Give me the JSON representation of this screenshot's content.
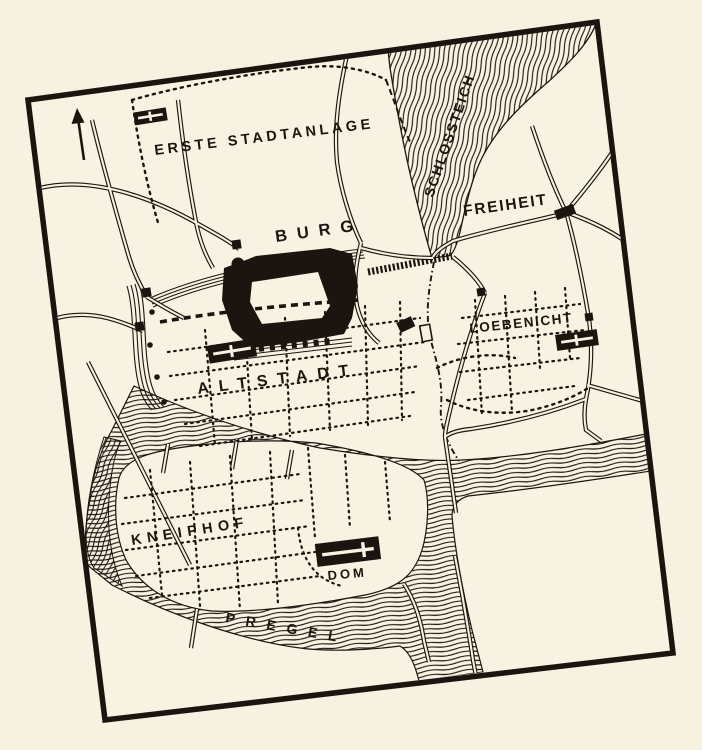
{
  "map": {
    "region_labels": {
      "erste_stadtanlage": "ERSTE STADTANLAGE",
      "schlossteich": "SCHLOSSTEICH",
      "freiheit": "FREIHEIT",
      "burg": "BURG",
      "altstadt": "ALTSTADT",
      "loebenicht": "LOEBENICHT",
      "kneiphof": "KNEIPHOF",
      "dom": "DOM",
      "pregel": "PREGEL"
    },
    "colors": {
      "paper": "#f6f1e1",
      "ink": "#1a150f"
    }
  }
}
